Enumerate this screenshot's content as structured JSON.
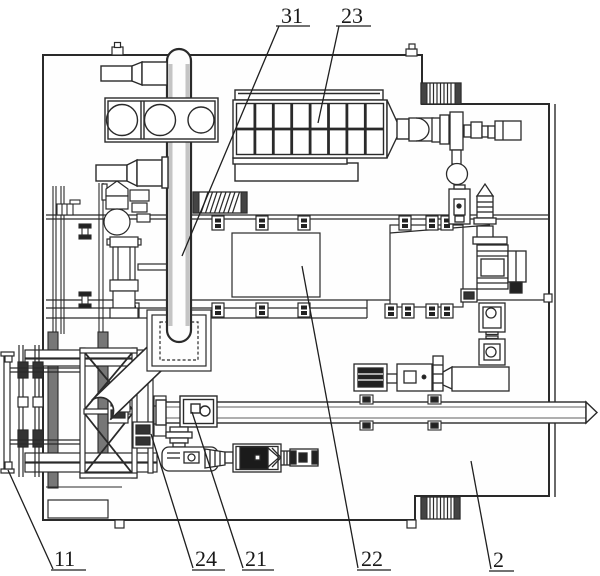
{
  "figure": {
    "type": "patent-mechanical-drawing-top-view",
    "labels": {
      "l31": "31",
      "l23": "23",
      "l11": "11",
      "l24": "24",
      "l21": "21",
      "l22": "22",
      "l2": "2"
    },
    "colors": {
      "line": "#2a2a2a",
      "background": "#ffffff",
      "dark_fill": "#222222",
      "wall_gray": "#c4c4c4"
    }
  }
}
